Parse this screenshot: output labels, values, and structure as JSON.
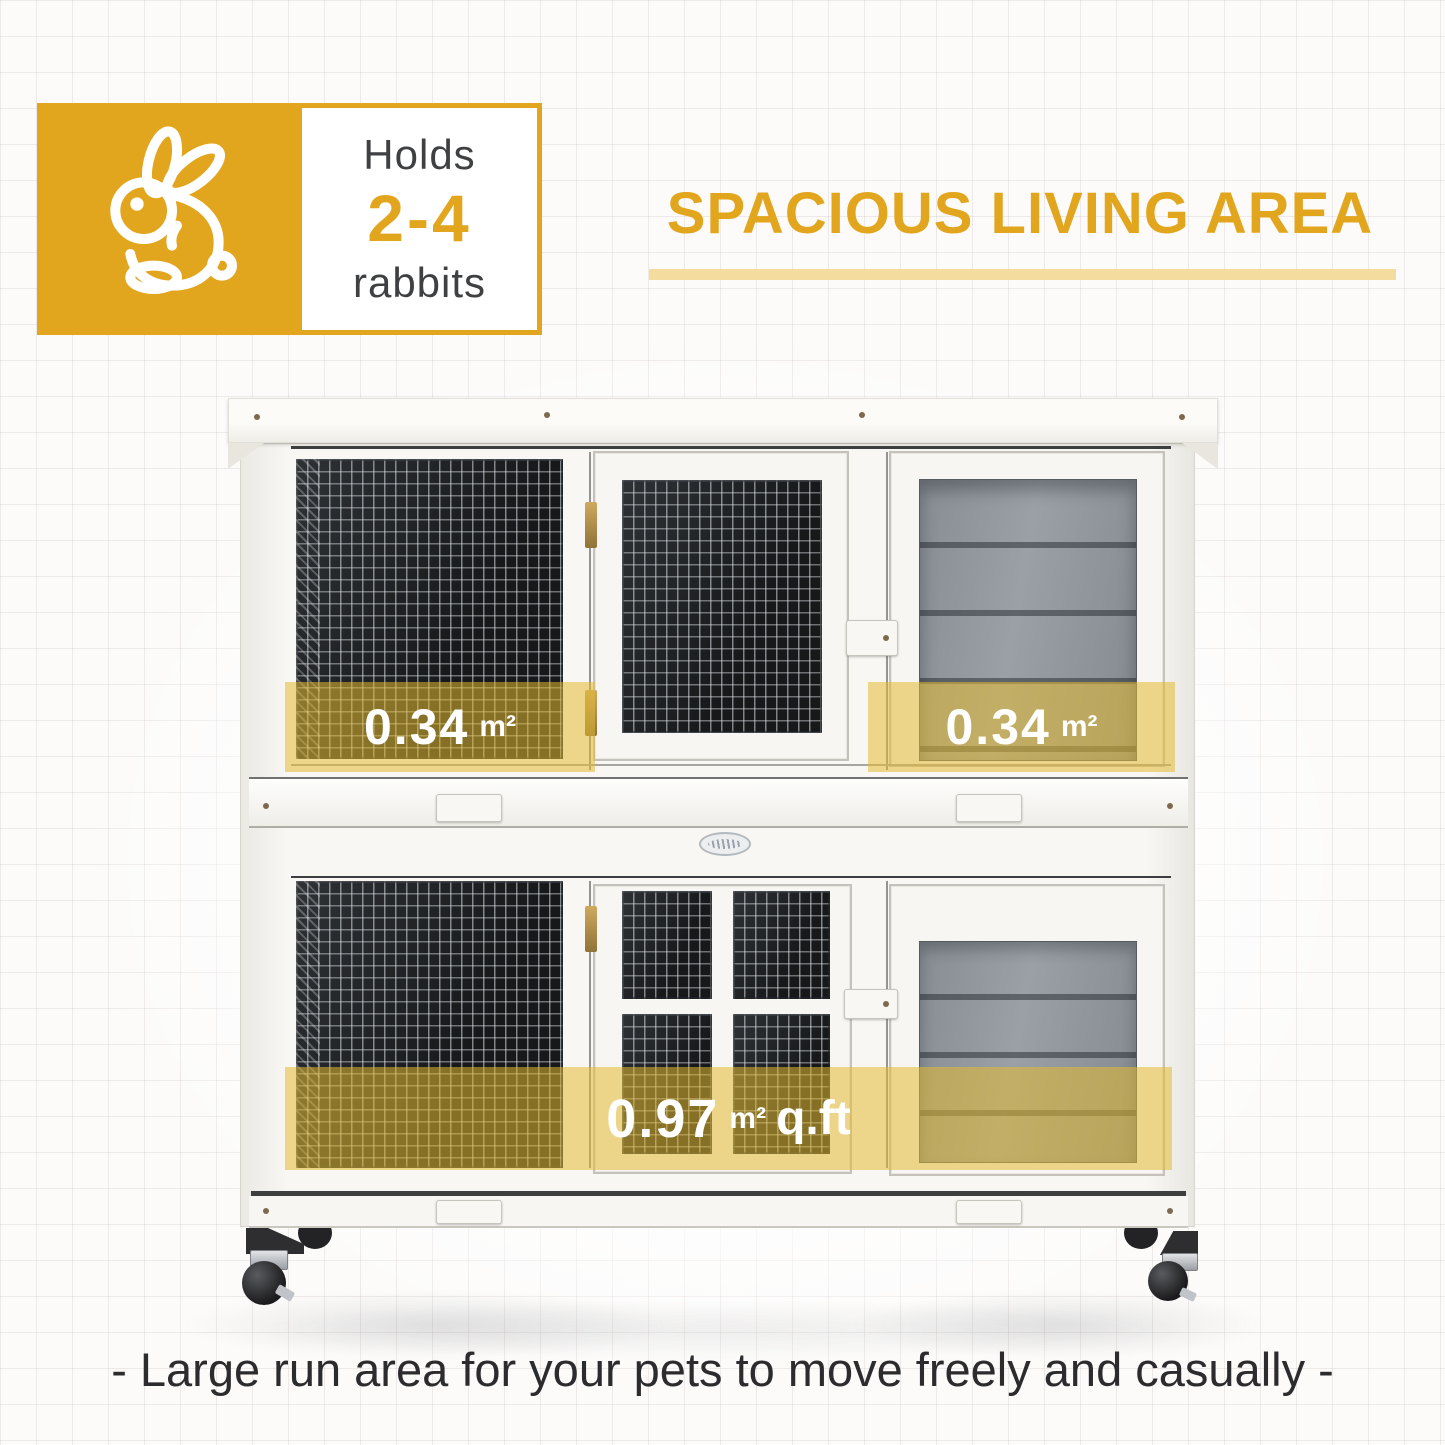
{
  "badge": {
    "line1": "Holds",
    "range": "2-4",
    "line2": "rabbits"
  },
  "heading": {
    "title": "SPACIOUS LIVING AREA"
  },
  "hutch": {
    "area_labels": {
      "upper_left": {
        "value": "0.34",
        "unit": "m²"
      },
      "upper_right": {
        "value": "0.34",
        "unit": "m²"
      },
      "lower": {
        "value": "0.97",
        "unit": "m²",
        "suffix": "q.ft"
      }
    }
  },
  "caption": {
    "text": "- Large run area for your pets to move freely and casually -"
  },
  "icons": {
    "rabbit": "rabbit-icon",
    "logo": "brand-logo-oval"
  },
  "colors": {
    "accent": "#E2A51E",
    "underline": "#F3DC9E",
    "overlay": "rgba(228,186,50,0.55)",
    "caption_color": "#2C2C2E",
    "text_dark": "#3F4042"
  }
}
